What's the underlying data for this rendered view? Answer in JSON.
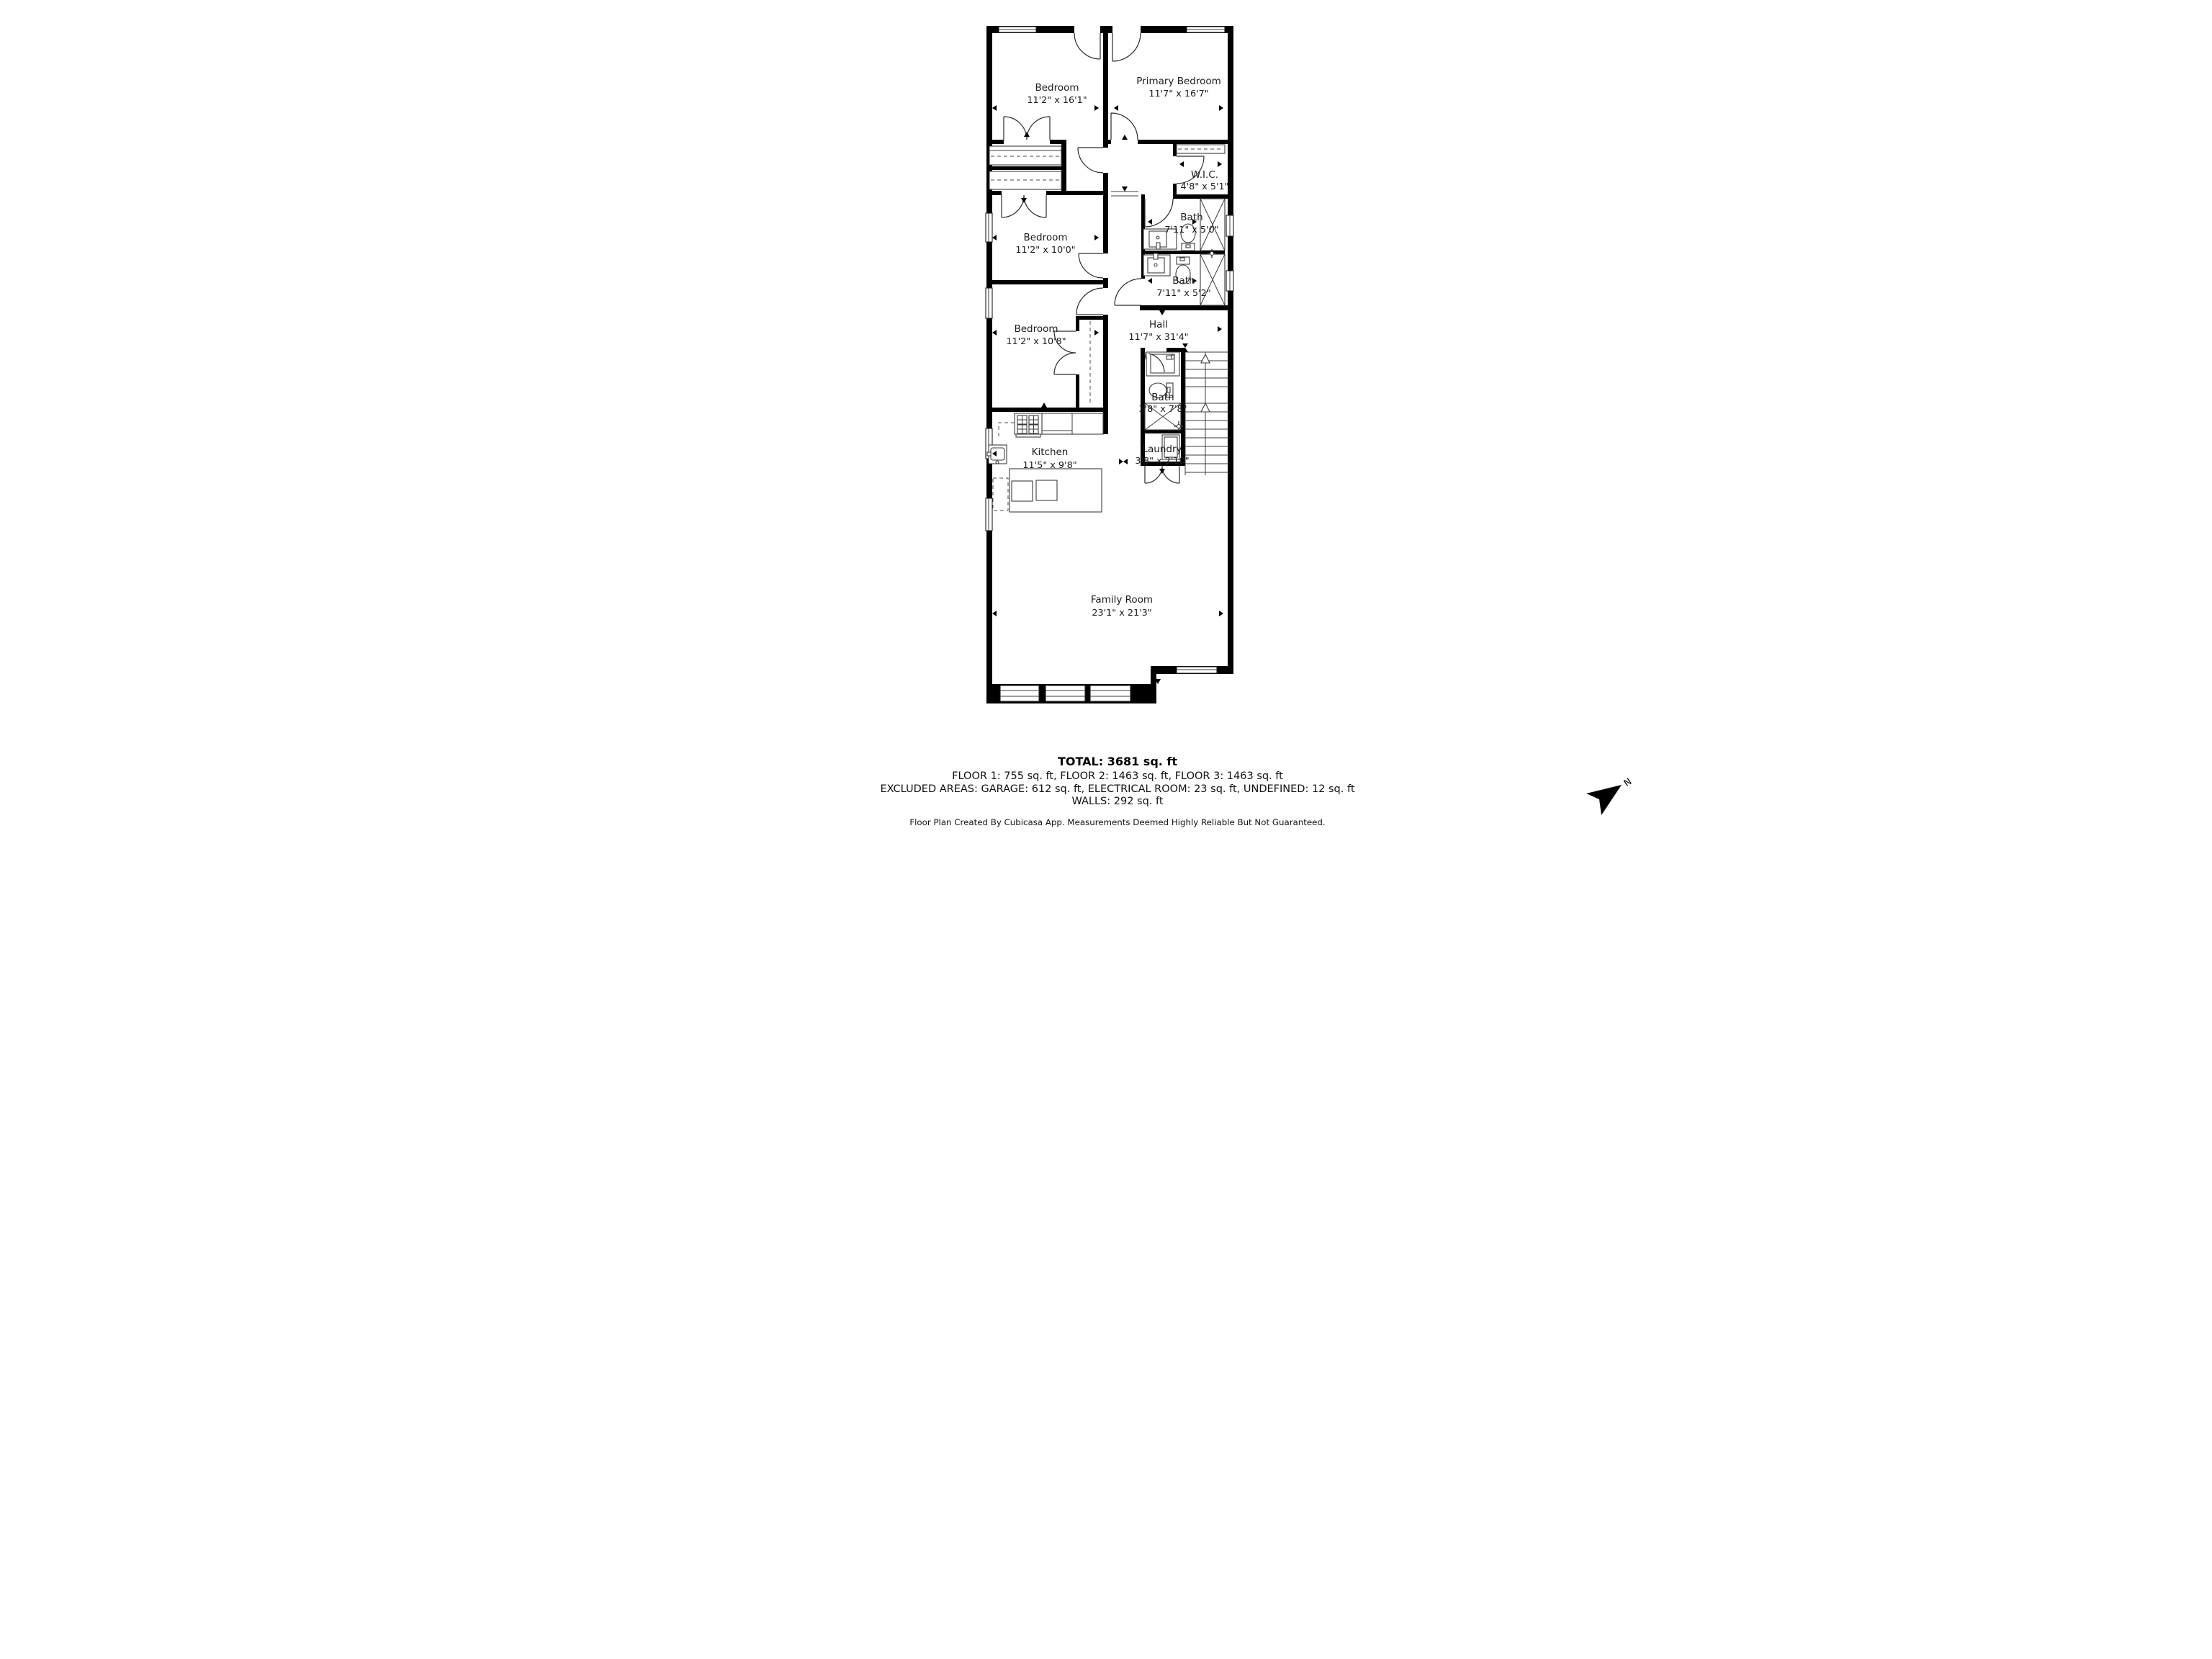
{
  "rooms": {
    "bedroom1": {
      "name": "Bedroom",
      "dims": "11'2\" x 16'1\""
    },
    "primary": {
      "name": "Primary Bedroom",
      "dims": "11'7\" x 16'7\""
    },
    "wic": {
      "name": "W.I.C.",
      "dims": "4'8\" x 5'1\""
    },
    "bath1": {
      "name": "Bath",
      "dims": "7'11\" x 5'0\""
    },
    "bath2": {
      "name": "Bath",
      "dims": "7'11\" x 5'2\""
    },
    "hall": {
      "name": "Hall",
      "dims": "11'7\" x 31'4\""
    },
    "bedroom2": {
      "name": "Bedroom",
      "dims": "11'2\" x 10'0\""
    },
    "bedroom3": {
      "name": "Bedroom",
      "dims": "11'2\" x 10'8\""
    },
    "bath3": {
      "name": "Bath",
      "dims": "3'8\" x 7'8\""
    },
    "laundry": {
      "name": "Laundry",
      "dims": "3'8\" x 2'10\""
    },
    "kitchen": {
      "name": "Kitchen",
      "dims": "11'5\" x 9'8\""
    },
    "family": {
      "name": "Family Room",
      "dims": "23'1\" x 21'3\""
    }
  },
  "summary": {
    "total": "TOTAL: 3681 sq. ft",
    "floors": "FLOOR 1: 755 sq. ft, FLOOR 2: 1463 sq. ft, FLOOR 3: 1463 sq. ft",
    "excluded": "EXCLUDED AREAS: GARAGE: 612 sq. ft, ELECTRICAL ROOM: 23 sq. ft, UNDEFINED: 12 sq. ft",
    "walls": "WALLS: 292 sq. ft",
    "disclaimer": "Floor Plan Created By Cubicasa App. Measurements Deemed Highly Reliable But Not Guaranteed."
  },
  "compass": {
    "label": "N"
  },
  "colors": {
    "wall": "#000000",
    "background": "#ffffff"
  }
}
